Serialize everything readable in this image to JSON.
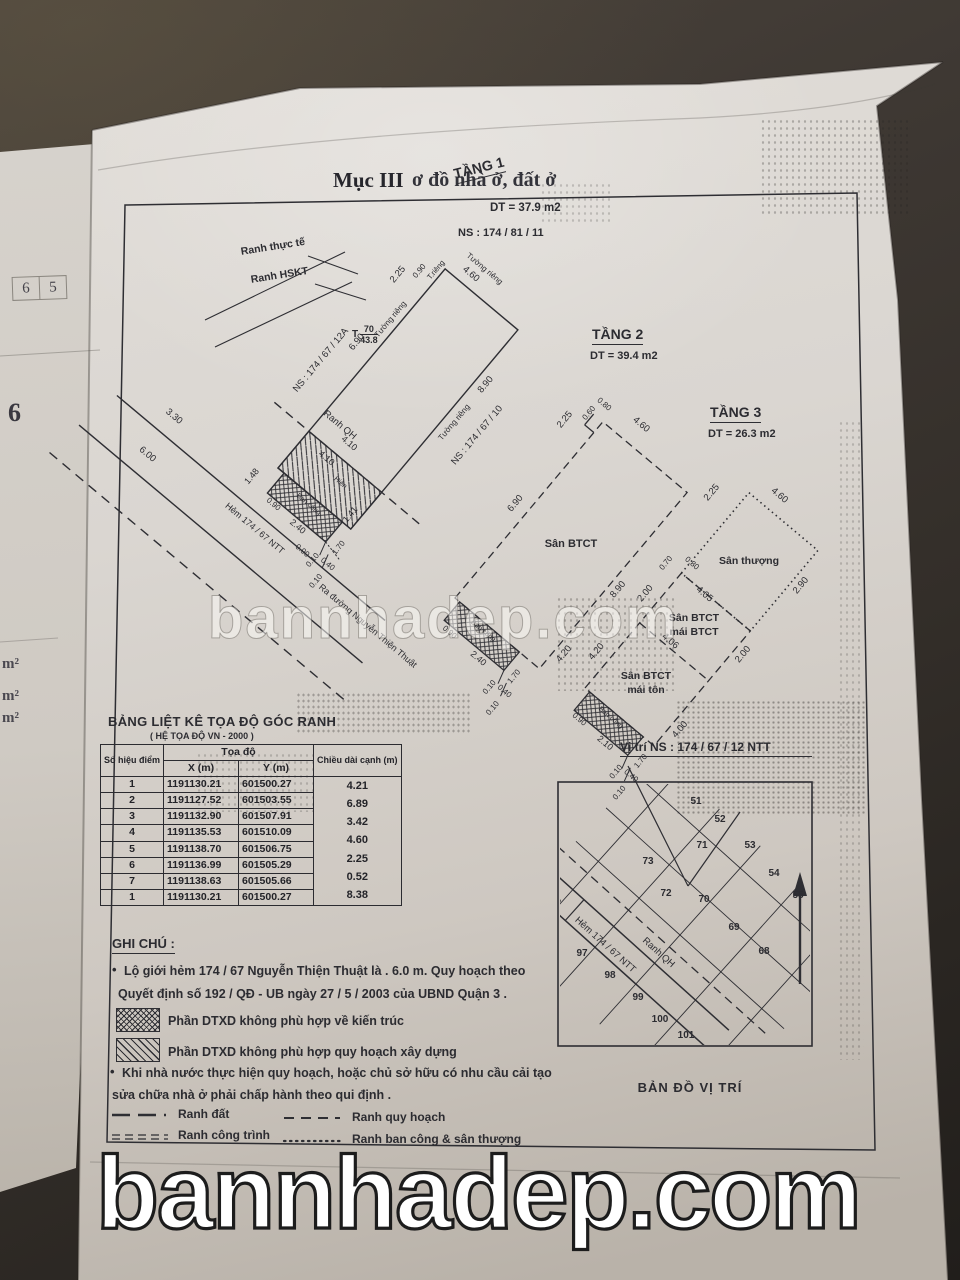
{
  "photo": {
    "watermark_mid": "bannhadep.com",
    "watermark_bottom": "bannhadep.com"
  },
  "header": {
    "section": "Mục III",
    "title_rest": "ơ đồ nhà ở, đất ở"
  },
  "underpage": {
    "cell_a": "6",
    "cell_b": "5",
    "big": "6",
    "m2": "m²"
  },
  "floor1": {
    "title": "TẦNG 1",
    "area": "DT = 37.9 m2",
    "ns": "NS : 174 / 81 / 11",
    "ranh_thuc_te": "Ranh thực tế",
    "ranh_hskt": "Ranh HSKT",
    "ns_12a": "NS : 174 / 67 / 12A",
    "ns_10": "NS : 174 / 67 / 10",
    "tuong_rieng": "Tường riêng",
    "t_rieng": "T.riêng",
    "bench_t": "T",
    "bench_top": "70",
    "bench_bot": "43.8",
    "ranh_qh": "Ranh QH",
    "hien": "Hiên",
    "hem": "Hẻm 174 / 67 NTT",
    "ra_duong": "Ra đường Nguyễn Thiện Thuật",
    "ban_cong": "Ban công",
    "dims": [
      "2.25",
      "0.90",
      "4.60",
      "6.90",
      "8.90",
      "1.48",
      "4.10",
      "4.10",
      "1.41",
      "6.00",
      "3.30",
      "2.40",
      "0.90",
      "1.70",
      "0.10",
      "0.10",
      "0.40",
      "0.90"
    ]
  },
  "floor2": {
    "title": "TẦNG 2",
    "area": "DT = 39.4 m2",
    "san_btct": "Sân BTCT",
    "ban_cong": "Ban công",
    "dims": [
      "2.25",
      "0.60",
      "0.80",
      "4.60",
      "6.90",
      "8.90",
      "4.20",
      "0.90",
      "2.40",
      "1.70",
      "0.10",
      "0.10",
      "0.40"
    ]
  },
  "floor3": {
    "title": "TẦNG 3",
    "area": "DT = 26.3 m2",
    "san_thuong": "Sân thượng",
    "san_btct": "Sân BTCT",
    "mai_btct": "mái BTCT",
    "mai_ton": "mái tôn",
    "ban_cong": "Ban công",
    "dims": [
      "2.25",
      "4.60",
      "0.70",
      "0.80",
      "2.00",
      "4.05",
      "2.90",
      "4.20",
      "4.06",
      "2.00",
      "4.00",
      "0.90",
      "2.10",
      "1.70",
      "0.10",
      "0.10",
      "0.40"
    ]
  },
  "table": {
    "title": "BẢNG LIỆT KÊ TỌA ĐỘ GÓC RANH",
    "subtitle": "( HỆ TỌA ĐỘ VN - 2000 )",
    "col_point": "Số hiệu điểm",
    "col_coord": "Tọa độ",
    "col_x": "X (m)",
    "col_y": "Y (m)",
    "col_len": "Chiều dài cạnh (m)",
    "points": [
      "1",
      "2",
      "3",
      "4",
      "5",
      "6",
      "7",
      "1"
    ],
    "x": [
      "1191130.21",
      "1191127.52",
      "1191132.90",
      "1191135.53",
      "1191138.70",
      "1191136.99",
      "1191138.63",
      "1191130.21"
    ],
    "y": [
      "601500.27",
      "601503.55",
      "601507.91",
      "601510.09",
      "601506.75",
      "601505.29",
      "601505.66",
      "601500.27"
    ],
    "lengths": [
      "4.21",
      "6.89",
      "3.42",
      "4.60",
      "2.25",
      "0.52",
      "8.38"
    ]
  },
  "notes": {
    "heading": "GHI CHÚ :",
    "line1a": "Lộ giới hẻm 174 / 67 Nguyễn Thiện Thuật là . 6.0 m. Quy hoạch theo",
    "line1b": "Quyết định số 192 / QĐ - UB ngày 27 / 5 / 2003 của UBND Quận 3 .",
    "hatch_cross": "Phần DTXD không phù hợp về kiến trúc",
    "hatch_diag": "Phần DTXD không phù hợp quy hoạch xây dựng",
    "line2a": "Khi nhà nước thực hiện quy hoạch, hoặc chủ sở hữu có nhu cầu cải tạo",
    "line2b": "sửa chữa nhà ở phải chấp hành theo qui định .",
    "legend": [
      {
        "label": "Ranh đất"
      },
      {
        "label": "Ranh quy hoạch"
      },
      {
        "label": "Ranh công trình"
      },
      {
        "label": "Ranh ban công & sân thượng"
      }
    ]
  },
  "map": {
    "title": "Vị trí NS : 174 / 67 / 12 NTT",
    "caption": "BẢN ĐỒ VỊ TRÍ",
    "hem": "Hẻm 174 / 67 NTT",
    "ranh_qh": "Ranh QH",
    "d600": "6.00",
    "lots": [
      "51",
      "52",
      "71",
      "53",
      "73",
      "54",
      "72",
      "70",
      "55",
      "69",
      "68",
      "97",
      "98",
      "99",
      "100",
      "101"
    ]
  }
}
